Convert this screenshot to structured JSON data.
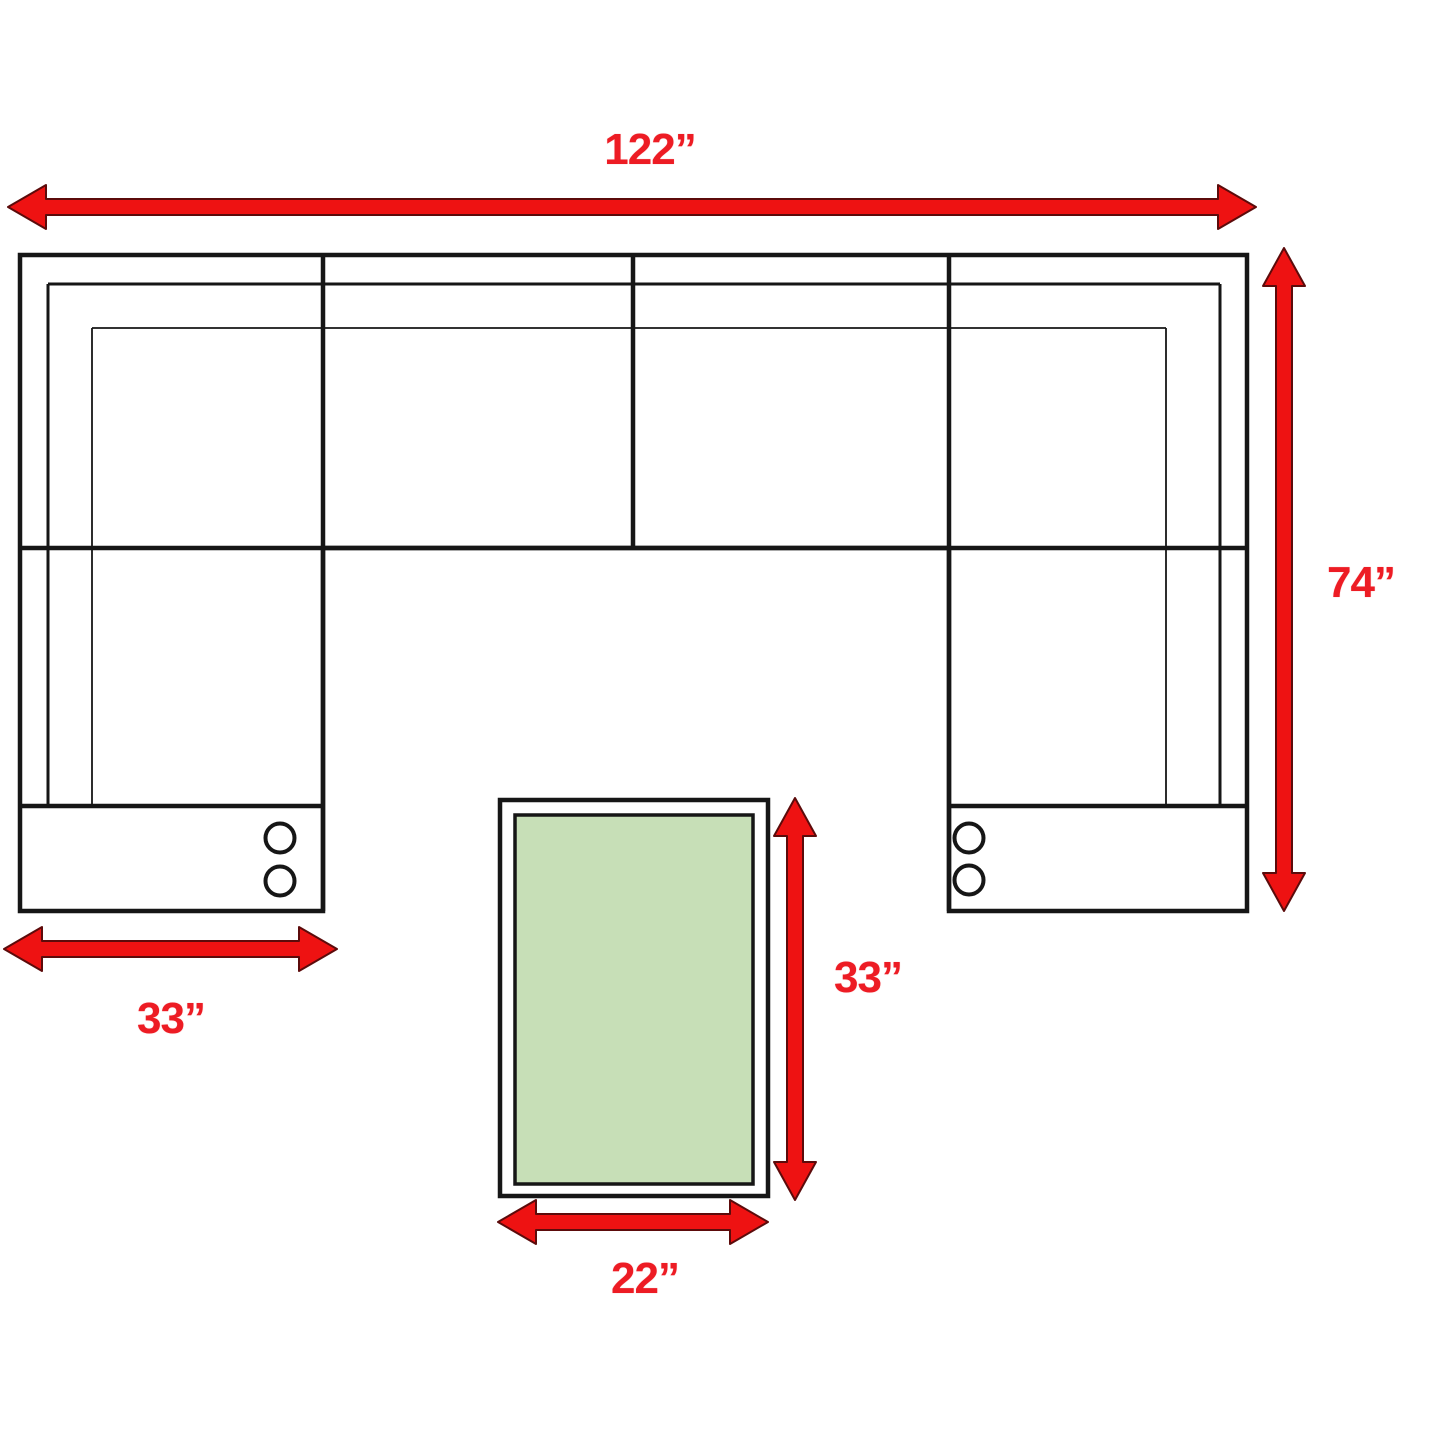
{
  "diagram": {
    "kind": "sectional-sofa-with-ottoman-dimension-plan",
    "labels": {
      "overall_width": "122”",
      "overall_depth": "74”",
      "chaise_width": "33”",
      "ottoman_length": "33”",
      "ottoman_width": "22”"
    },
    "colors": {
      "dimension_text_red": "#ed1c24",
      "arrow_fill_red": "#ee1212",
      "arrow_outline_dark_red": "#5c0b0b",
      "outline_black": "#161616",
      "ottoman_green": "#c7dfb7",
      "background_white": "#ffffff"
    }
  }
}
